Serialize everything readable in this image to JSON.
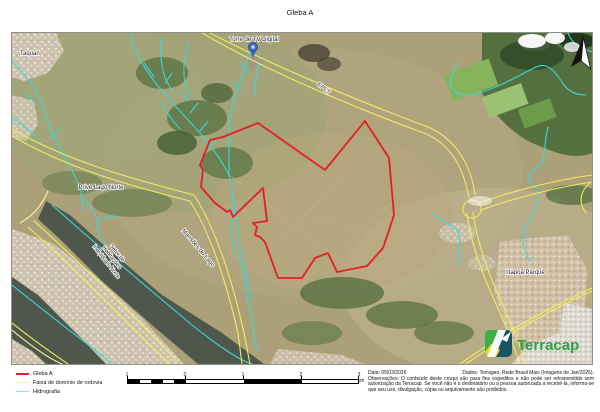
{
  "page": {
    "title": "Gleba A"
  },
  "map": {
    "labels": {
      "taquari": "Taquari",
      "torre": "Torre de TV Digital",
      "epct": "EPCT",
      "prive": "Privê Lago Norte",
      "shin_l1": "Setor de",
      "shin_l2": "Habitações",
      "shin_l3": "Individuais Norte",
      "mansoes": "Mansões do Lago",
      "itapoa": "Itapoã Parque"
    },
    "logo_text": "Terracap"
  },
  "legend": {
    "items": [
      {
        "label": "Gleba A",
        "color": "#e51f23"
      },
      {
        "label": "Faixa de domínio de rodovia",
        "color": "#f6f29a"
      },
      {
        "label": "Hidrografia",
        "color": "#7fe9e9"
      }
    ]
  },
  "scalebar": {
    "ticks": [
      "1",
      "0",
      "1",
      "2"
    ],
    "end_label": "3 km"
  },
  "credits": {
    "date_label": "Data: 05/03/2026",
    "source_label": "Dados: Terrageo, Rede Brasil Mais (Imagens de Jan/2026).",
    "obs": "Observações: O conteúdo deste croqui são para fins expeditos e não pode ser retransmitido sem autorização da Terracap. Se você não é o destinatário ou a pessoa autorizada a recebê-la, informa-se que seu uso, divulgação, cópia ou arquivamento são proibidos."
  },
  "colors": {
    "gleba": "#e51f23",
    "road": "#f1ed5a",
    "hydro": "#38d8d8",
    "water": "#4f574d",
    "logo_green": "#31a146"
  }
}
